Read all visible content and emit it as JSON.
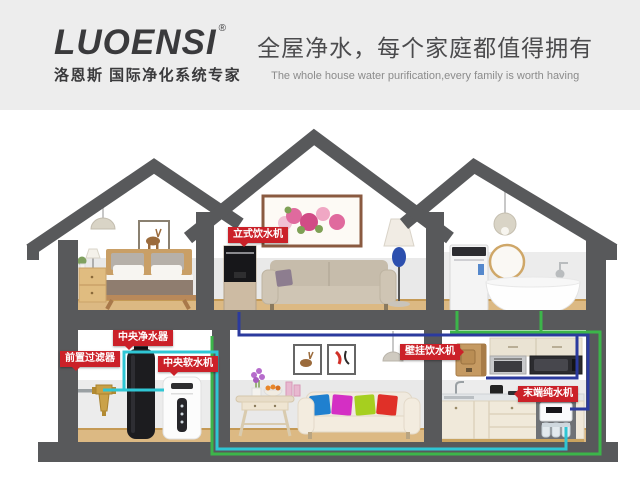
{
  "header": {
    "logo_text": "LUOENSI",
    "logo_reg": "®",
    "logo_tagline": "洛恩斯 国际净化系统专家",
    "title": "全屋净水，每个家庭都值得拥有",
    "subtitle": "The whole house water purification,every family is worth having"
  },
  "labels": {
    "standing_dispenser": "立式饮水机",
    "central_purifier": "中央净水器",
    "pre_filter": "前置过滤器",
    "central_softener": "中央软水机",
    "wall_dispenser": "壁挂饮水机",
    "terminal_purifier": "末端纯水机"
  },
  "colors": {
    "label_red": "#cb2129",
    "pipe_cyan": "#2fc6d4",
    "pipe_green": "#3cb54a",
    "pipe_blue": "#2b3a9e",
    "structure_gray": "#58595b"
  }
}
